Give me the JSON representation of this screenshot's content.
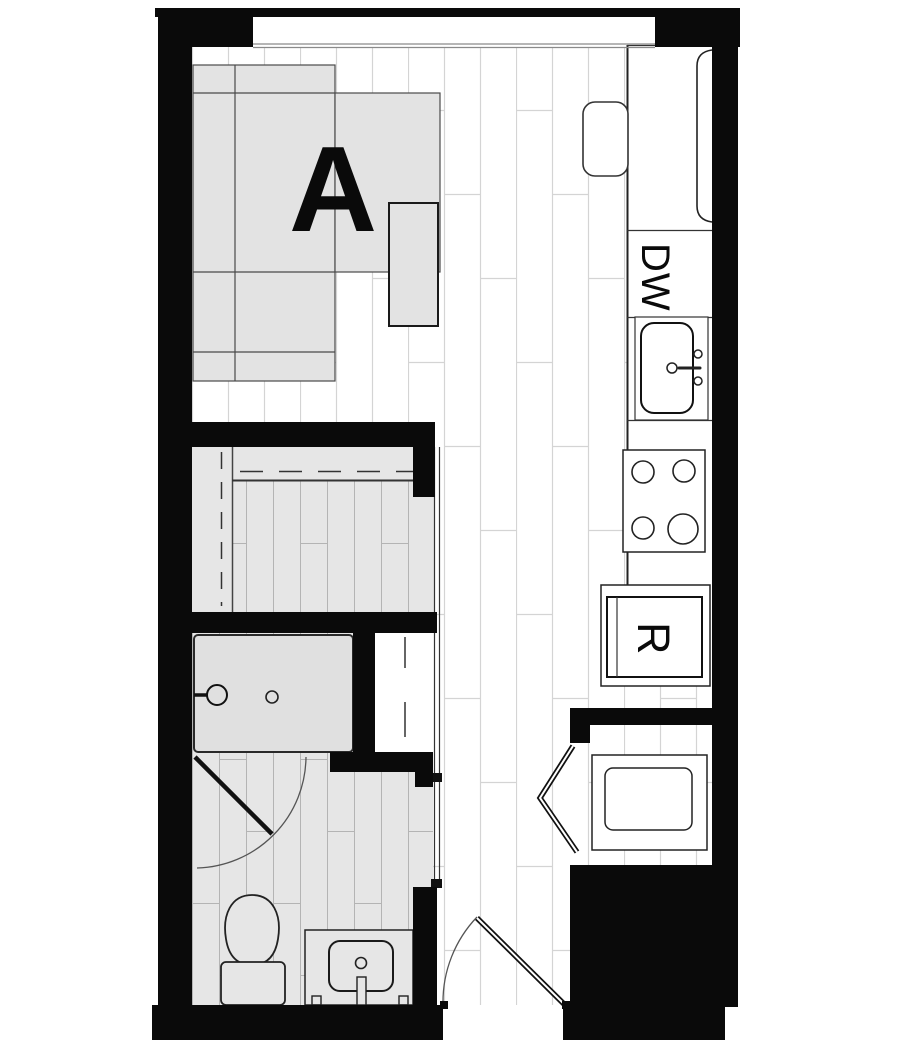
{
  "plan": {
    "unit_label": "A",
    "appliance_labels": {
      "dishwasher": "DW",
      "refrigerator": "R"
    },
    "colors": {
      "wall": "#0a0a0a",
      "room_fill": "#e6e6e6",
      "plank_line": "#d4d4d4",
      "tile_line": "#b4b4b4",
      "furniture_fill": "#e3e3e3",
      "furniture_line": "#4a4a4a",
      "fixture_line": "#222222",
      "door_arc": "#555555",
      "label_color": "#0a0a0a"
    }
  }
}
